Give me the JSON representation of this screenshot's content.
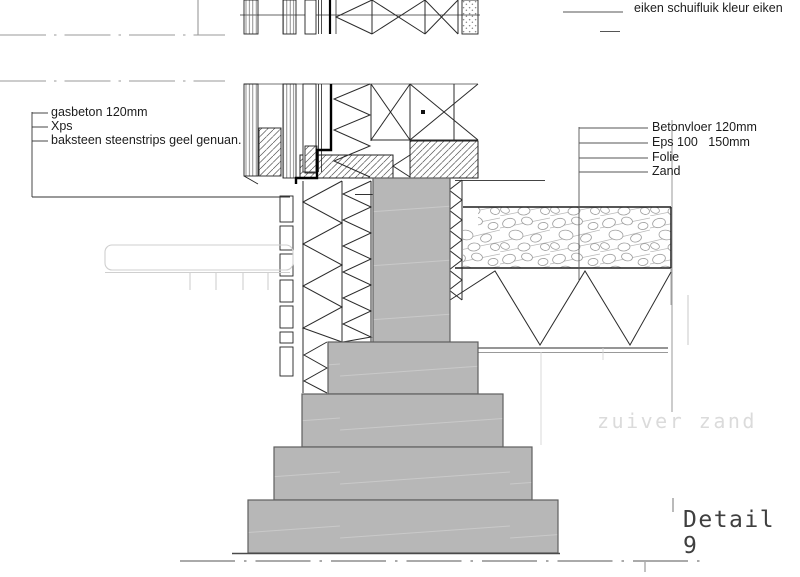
{
  "annotations": {
    "top_right_label": "eiken schuifluik kleur eiken",
    "left_labels": [
      "gasbeton 120mm",
      "Xps",
      "baksteen steenstrips geel genuan."
    ],
    "right_labels": [
      "Betonvloer 120mm",
      "Eps 100   150mm",
      "Folie",
      "Zand"
    ],
    "watermark": "zuiver zand",
    "title": "Detail 9"
  },
  "colors": {
    "background": "#ffffff",
    "concrete_fill": "#b7b7b7",
    "concrete_outline": "#5f5f5f",
    "line_dark": "#1f1f1f",
    "line_gray": "#999999",
    "faint_line": "#cfcfcf",
    "watermark_text": "#dbdbdb",
    "title_text": "#3f3f3f"
  }
}
